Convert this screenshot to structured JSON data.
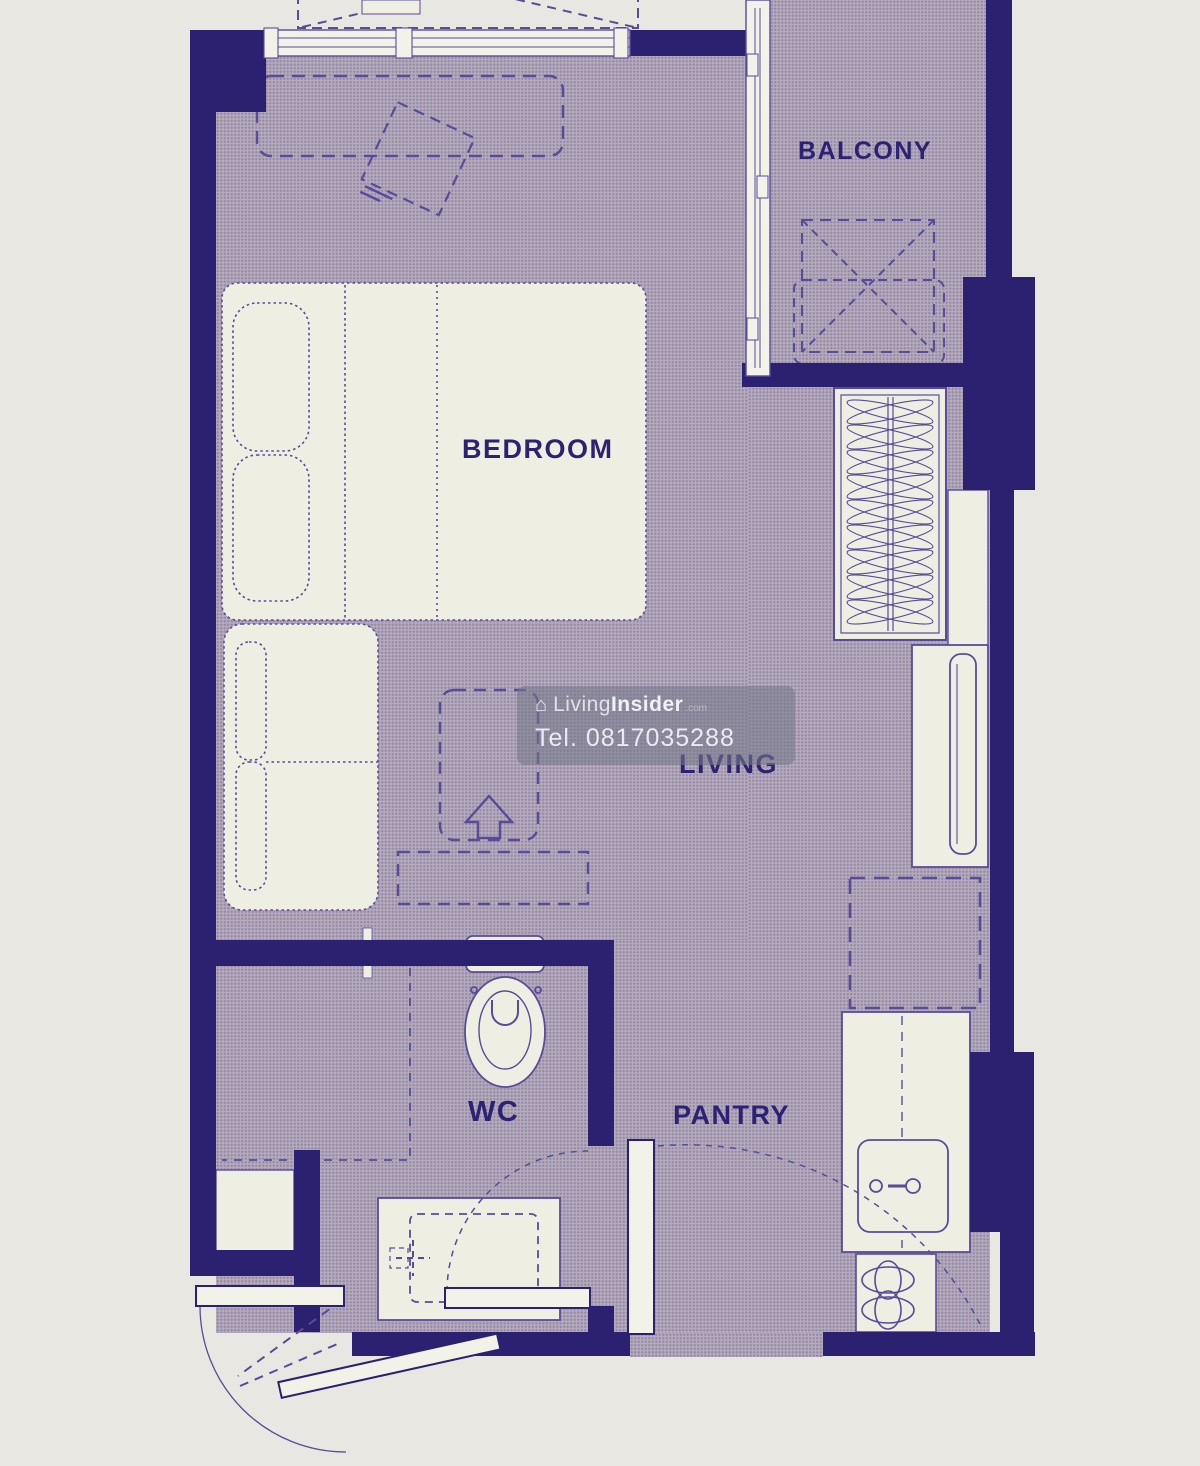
{
  "rooms": {
    "bedroom": "BEDROOM",
    "balcony": "BALCONY",
    "living": "LIVING",
    "wc": "WC",
    "pantry": "PANTRY"
  },
  "watermark": {
    "logo_icon": "house-icon",
    "brand_light": "Living",
    "brand_bold": "Insider",
    "brand_suffix": ".com",
    "phone": "Tel. 0817035288"
  },
  "colors": {
    "paper": "#e9e7e1",
    "floor": "#b5aabc",
    "wall": "#2b2170",
    "line": "#5a4b99",
    "furniture_fill": "#efeee3",
    "label_text": "#2c2173",
    "watermark_bg": "rgba(118,121,138,0.58)",
    "watermark_text": "#eef1f7"
  },
  "furniture_icons": [
    "double-bed",
    "pillow",
    "headboard-cushions",
    "desk-dashed-outline",
    "chair-dashed-outline",
    "sofa",
    "tv-cabinet-dashed",
    "up-arrow-marker",
    "sideboard-dashed",
    "wardrobe-with-hangers",
    "tv-console",
    "flat-tv",
    "fridge-space-dashed",
    "kitchen-counter",
    "kitchen-sink",
    "cooktop-hob",
    "toilet",
    "shower-partition-dashed",
    "vanity-basin",
    "ac-condenser-balcony",
    "ac-ledge-top",
    "window-top",
    "sliding-door-balcony",
    "entrance-door-swing",
    "wc-door-swing",
    "service-door-swing"
  ]
}
